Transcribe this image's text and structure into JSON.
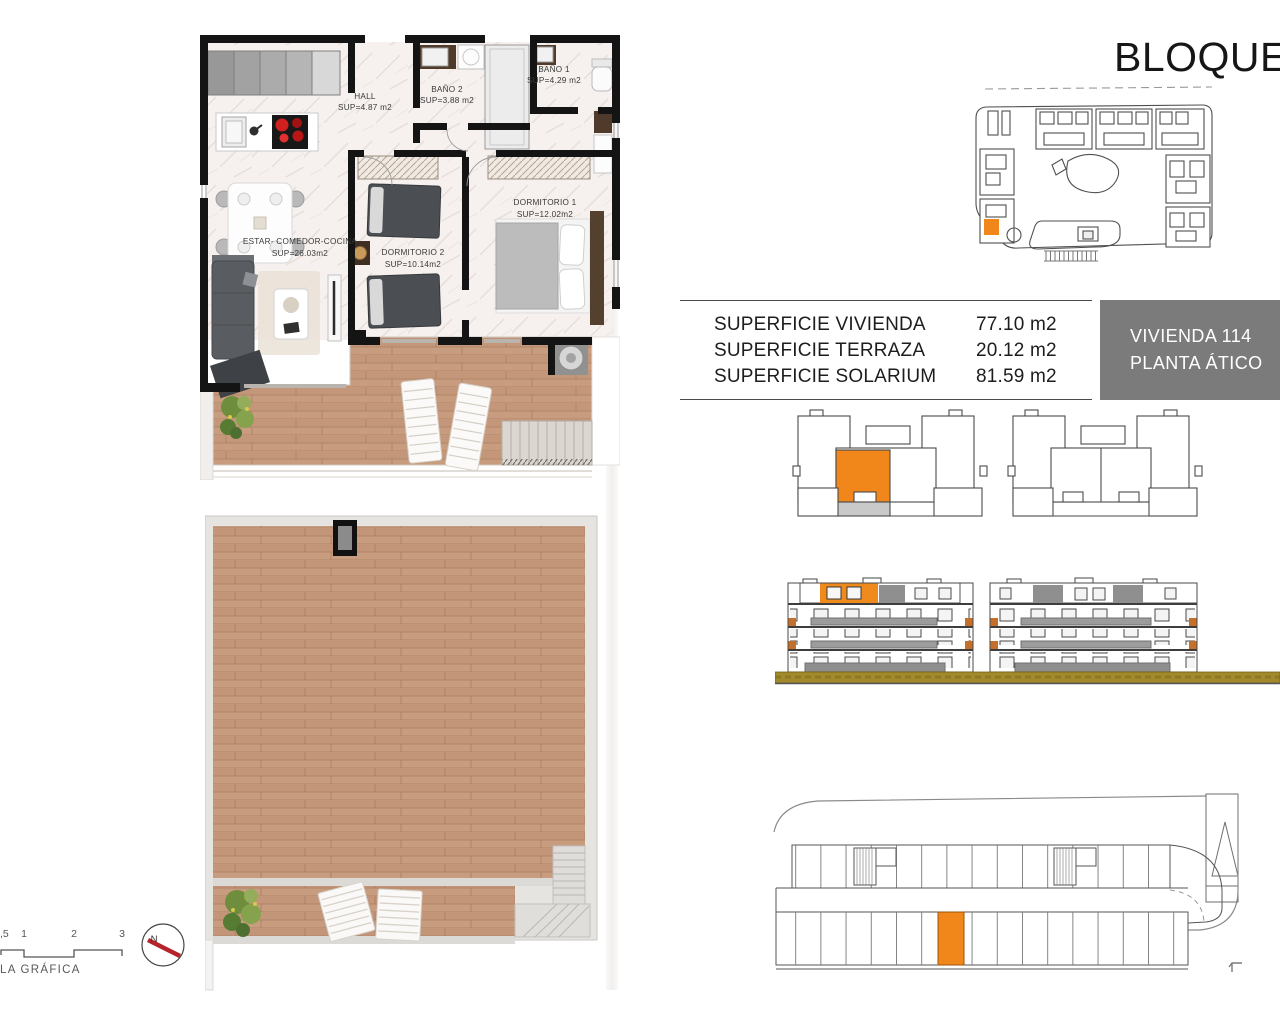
{
  "page": {
    "title": "BLOQUE"
  },
  "areas_table": {
    "rows": [
      {
        "label": "SUPERFICIE VIVIENDA",
        "value": "77.10 m2"
      },
      {
        "label": "SUPERFICIE TERRAZA",
        "value": "20.12 m2"
      },
      {
        "label": "SUPERFICIE SOLARIUM",
        "value": "81.59 m2"
      }
    ]
  },
  "unit_card": {
    "name": "VIVIENDA 114",
    "floor": "PLANTA ÁTICO",
    "bg": "#7b7b7b"
  },
  "floor_plan": {
    "rooms": [
      {
        "name": "HALL",
        "area": "SUP=4.87 m2"
      },
      {
        "name": "BAÑO 2",
        "area": "SUP=3.88 m2"
      },
      {
        "name": "BAÑO 1",
        "area": "SUP=4.29 m2"
      },
      {
        "name": "DORMITORIO 1",
        "area": "SUP=12.02m2"
      },
      {
        "name": "DORMITORIO 2",
        "area": "SUP=10.14m2"
      },
      {
        "name": "ESTAR- COMEDOR-COCINA",
        "area": "SUP=26.03m2"
      }
    ]
  },
  "scale_bar": {
    "ticks": [
      ",5",
      "1",
      "2",
      "3"
    ],
    "label": "LA GRÁFICA"
  },
  "compass": {
    "north_label": "N"
  },
  "colors": {
    "accent_orange": "#F1861B",
    "unit_card_gray": "#7B7B7B",
    "ground_olive": "#A28A2C",
    "wood": "#C99E80",
    "marble": "#F6F1EE",
    "wall_black": "#141414",
    "compass_red": "#B5232B"
  }
}
